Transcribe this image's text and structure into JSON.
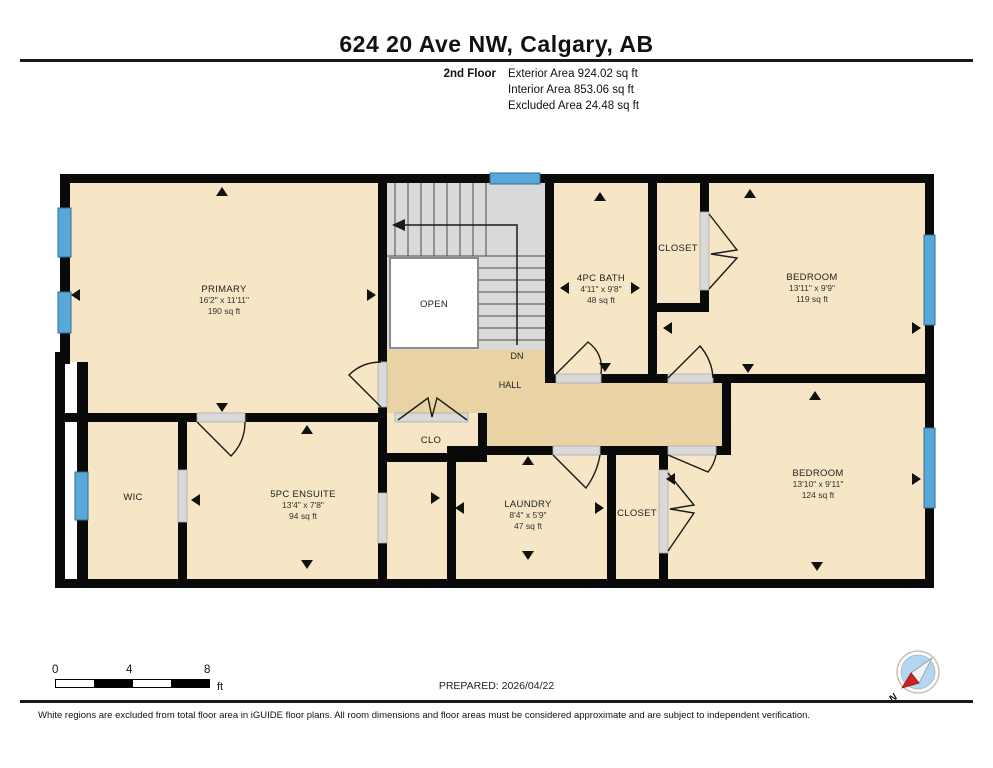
{
  "header": {
    "title": "624 20 Ave NW, Calgary, AB",
    "floor_label": "2nd Floor",
    "exterior_area": "Exterior Area 924.02 sq ft",
    "interior_area": "Interior Area 853.06 sq ft",
    "excluded_area": "Excluded Area 24.48 sq ft"
  },
  "plan": {
    "rooms": [
      {
        "name": "PRIMARY",
        "dims": "16'2\" x 11'11\"",
        "area": "190 sq ft"
      },
      {
        "name": "4PC BATH",
        "dims": "4'11\" x 9'8\"",
        "area": "48 sq ft"
      },
      {
        "name": "CLOSET",
        "dims": "",
        "area": ""
      },
      {
        "name": "BEDROOM",
        "dims": "13'11\" x 9'9\"",
        "area": "119 sq ft"
      },
      {
        "name": "WIC",
        "dims": "",
        "area": ""
      },
      {
        "name": "5PC ENSUITE",
        "dims": "13'4\" x 7'8\"",
        "area": "94 sq ft"
      },
      {
        "name": "CLO",
        "dims": "",
        "area": ""
      },
      {
        "name": "LAUNDRY",
        "dims": "8'4\" x 5'9\"",
        "area": "47 sq ft"
      },
      {
        "name": "CLOSET",
        "dims": "",
        "area": ""
      },
      {
        "name": "BEDROOM",
        "dims": "13'10\" x 9'11\"",
        "area": "124 sq ft"
      }
    ],
    "labels": {
      "open": "OPEN",
      "dn": "DN",
      "hall": "HALL"
    }
  },
  "scale_bar": {
    "tick0": "0",
    "tick1": "4",
    "tick2": "8",
    "unit": "ft"
  },
  "footer": {
    "prepared": "PREPARED: 2026/04/22",
    "disclaimer": "White regions are excluded from total floor area in iGUIDE floor plans. All room dimensions and floor areas must be considered approximate and are subject to independent verification."
  },
  "compass": {
    "north_label": "N"
  },
  "colors": {
    "wall": "#0a0a0a",
    "room_fill": "#f6e6c6",
    "hall_fill": "#e9d2a3",
    "stair_fill": "#d9d9d9",
    "window_blue": "#58a8d8",
    "compass_blue": "#b2d6ef",
    "compass_red": "#cc2222"
  }
}
